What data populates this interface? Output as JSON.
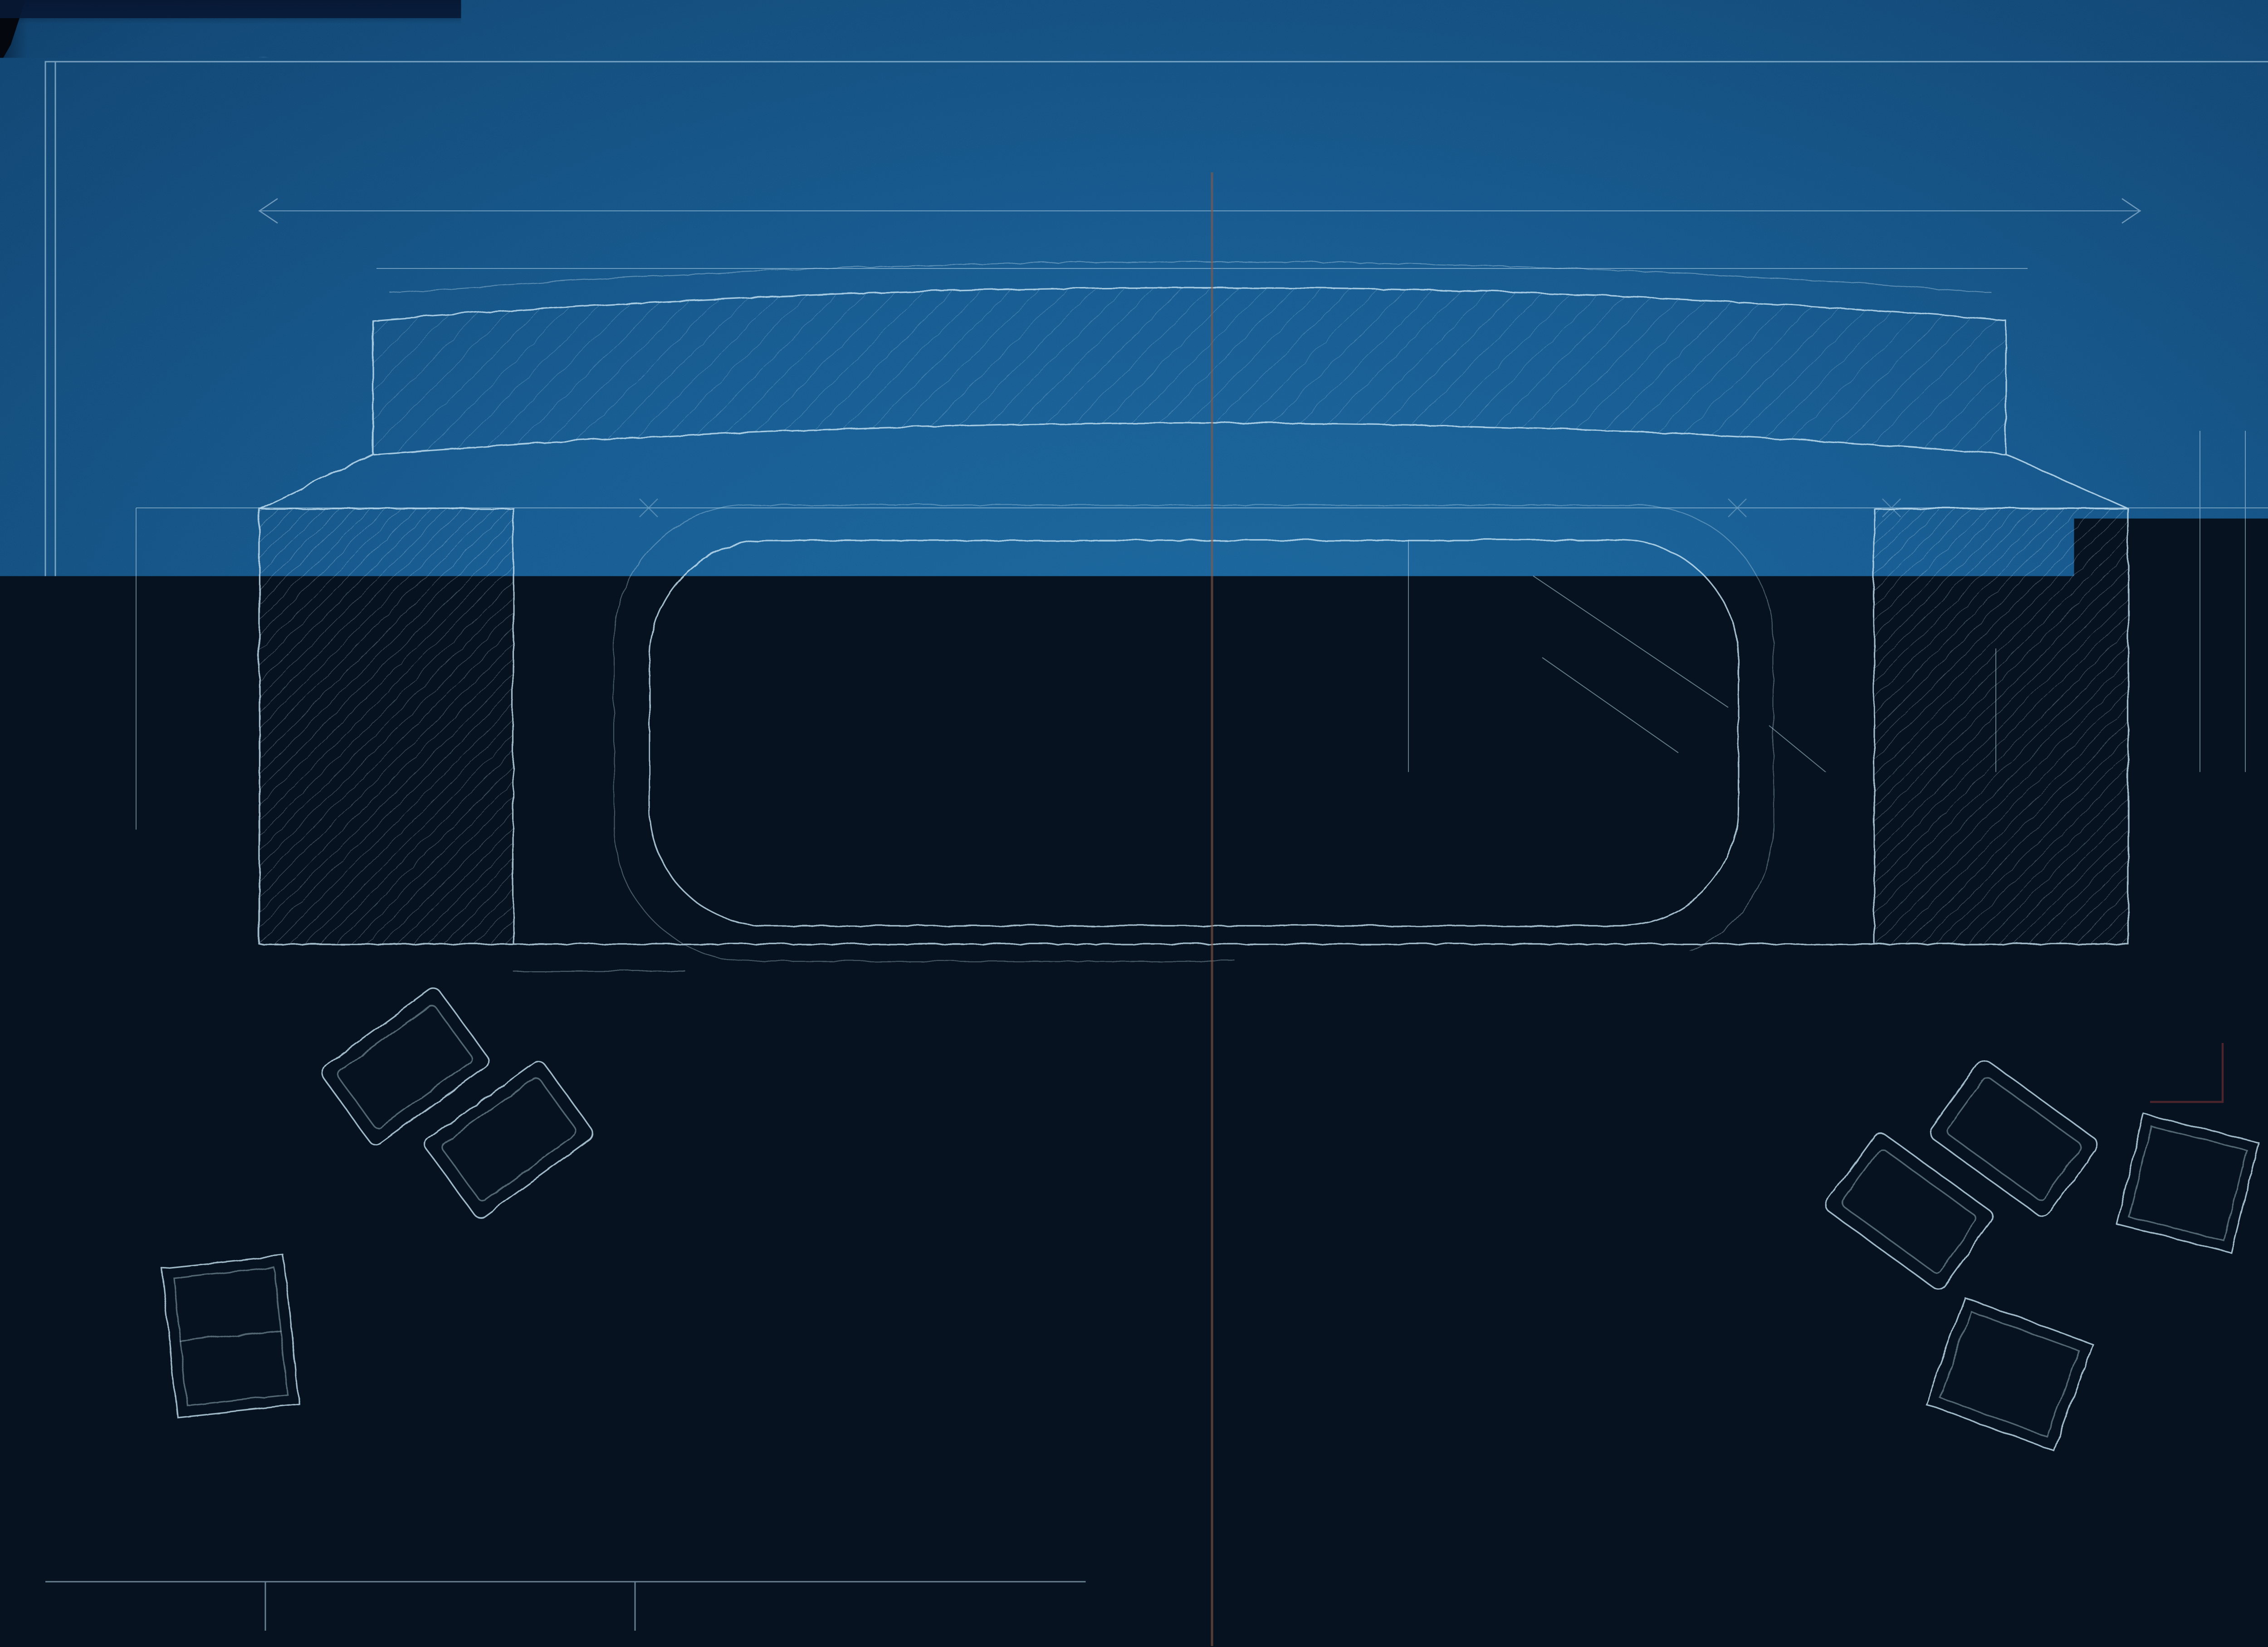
{
  "header": {
    "order_number": "Č. obj. 2540."
  },
  "model_labels": {
    "main": "Mod č. 5437 a 5437a",
    "c_mod": "Č. Mod.",
    "c_mod_number": "5438",
    "sl": "Š.L."
  },
  "sketch": {
    "dim54": "54",
    "dim22": "22",
    "t19": "t 19"
  },
  "dimensions": {
    "d590": "590",
    "d500": "500",
    "d340": "340",
    "d60L": "60",
    "d60R": "60",
    "d20a": "20",
    "d25a": "25",
    "d101": "101",
    "d20b": "20",
    "d45a": "45",
    "d42": "4.2",
    "d23": "23",
    "d104": "10.4",
    "d15a": "15",
    "d2240": "2240ϕ",
    "d2300": "2300ϕ",
    "d45b": "45",
    "d62": "62",
    "d15b": "15",
    "d15c": "15",
    "d15d": "15",
    "d2100": "2100ϕ",
    "d2057": "2057ϕ",
    "d1902": "1902ϕ",
    "d1955": "1955ϕ",
    "d22": "22",
    "d1900": "1900ϕ",
    "d30": "30 m/m",
    "d5x4": "5×4",
    "d40a": "40",
    "d72": "72",
    "d25b": "25",
    "d35": "35",
    "d25c": "25",
    "d255": "255",
    "d7633a": "76.33",
    "d7633b": "76.33",
    "d7633c": "76.33",
    "d1a": "1",
    "d10a": "10",
    "d1b": "1",
    "d10b": "10",
    "d380": "380",
    "d207": "207",
    "d40b": "40",
    "dphi230": "ϕ230",
    "dphi32": "ϕ32",
    "dphi40": "ϕ40",
    "d100": "100",
    "d1950": "1950ϕ",
    "d1697": "1697ϕ",
    "d1955b": "1955ϕ",
    "a12": "A12"
  },
  "notes": {
    "vent_line1": "Počet a délka ventilačních",
    "vent_line2": "otvorů viz č.p. 6981",
    "ribs": "35 m/m síla — 12 žeber, rozdělení viz výkr. č. 6981",
    "spacing_line1": "vzdálenost pásem byla menší",
    "sheets": "Plechy dle v. č. 6983",
    "tubes_line1": "Pro 2 špičky mikanit. trubek pro chyl. jímy = 430 m/m odl.",
    "tubes_line1b": "seříznutí",
    "tubes_line2": "Pro 14 cívek = 56 trubek pro pevné vírky = 40 dl",
    "tubes_line2b": "rovno",
    "tubes_total": "Úhrnem 168 trubek",
    "tube_profile": "Profil trubky viz č. 6983",
    "remark_line1": "Poznámka: délka a, a, a hlav",
    "remark_line2": "vinutí, musí býti stejná.",
    "insert_line1": "Mezi vinutí vlož se 2× silná",
    "insert_line2": "vložka Š.",
    "stack_line1": "při skládání plechů bude",
    "stack_line2": "16 otvorů se přebrá na 16ϕ",
    "stack_line3": "a do 4 vraženy trubky",
    "care_line1": "pečlivě proti pálení,",
    "care_line2": "přesně podle žeber",
    "cover_ink_line1": "5/8˝ —",
    "cover_ink_line2": "na kryt.",
    "exciter_ink": "na víko s budičem.",
    "washer_ink": "vložka 2 ks."
  },
  "title_block": {
    "drawing_number": "6982",
    "machine_label": "DG.",
    "machine_spec": "200 KVA, 214 obr.",
    "title": "DETAIL STATORU. 1:1",
    "print_number": "17825",
    "signature": "Fj."
  },
  "colors": {
    "paper": "#11568c",
    "ink": "#d5ecf9",
    "crayon": "#dca53e",
    "red_pencil": "#a03c3c",
    "black_ink": "#0e1722"
  }
}
